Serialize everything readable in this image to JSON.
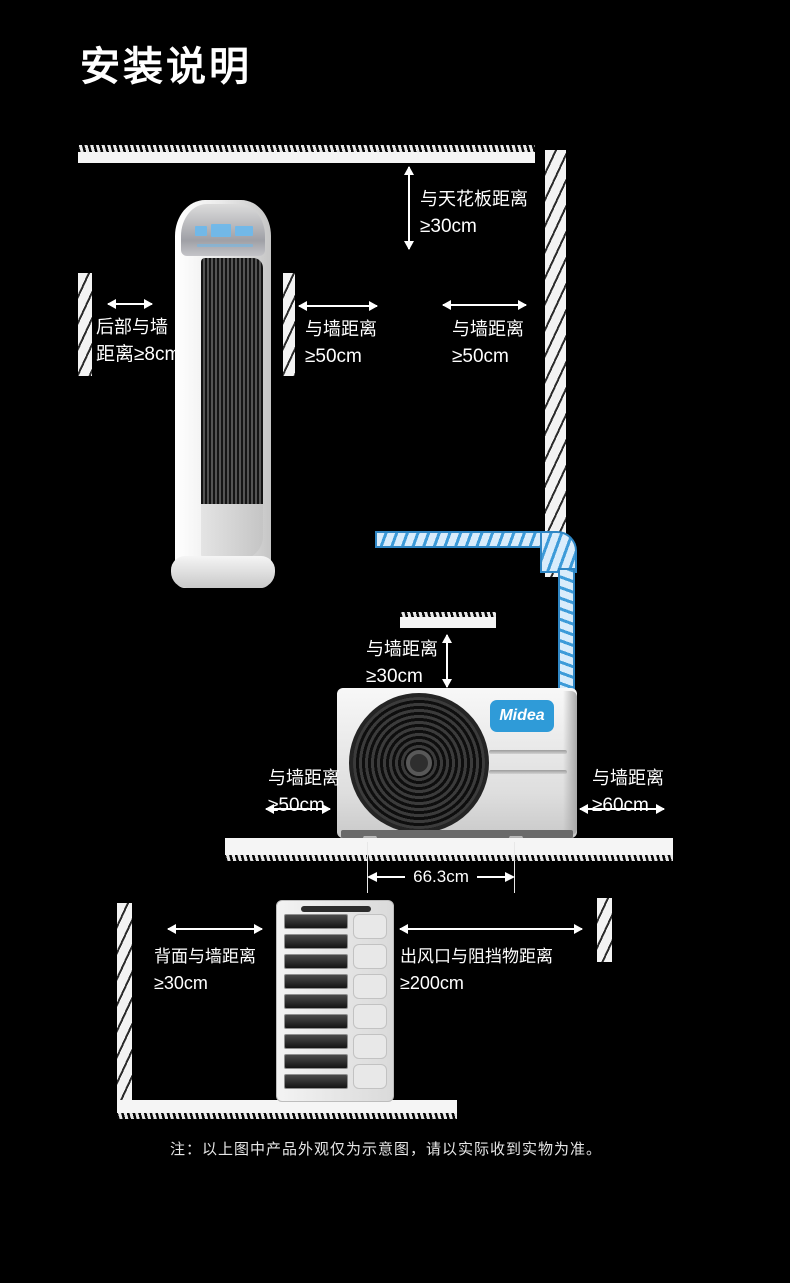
{
  "page": {
    "title": "安装说明",
    "note": "注：以上图中产品外观仅为示意图，请以实际收到实物为准。"
  },
  "colors": {
    "background": "#000000",
    "text": "#ffffff",
    "pipe_blue": "#3d9bd9",
    "logo_blue": "#2f9bd8"
  },
  "indoor_diagram": {
    "ceiling_clearance": {
      "label": "与天花板距离",
      "value": "≥30cm"
    },
    "rear_wall_clearance": {
      "label": "后部与墙",
      "value": "距离≥8cm"
    },
    "front_wall_clearance": {
      "label": "与墙距离",
      "value": "≥50cm"
    },
    "right_wall_clearance": {
      "label": "与墙距离",
      "value": "≥50cm"
    }
  },
  "outdoor_front_diagram": {
    "brand": "Midea",
    "top_wall_clearance": {
      "label": "与墙距离",
      "value": "≥30cm"
    },
    "left_wall_clearance": {
      "label": "与墙距离",
      "value": "≥50cm"
    },
    "right_wall_clearance": {
      "label": "与墙距离",
      "value": "≥60cm"
    },
    "unit_width": "66.3cm"
  },
  "outdoor_back_diagram": {
    "back_wall_clearance": {
      "label": "背面与墙距离",
      "value": "≥30cm"
    },
    "outlet_clearance": {
      "label": "出风口与阻挡物距离",
      "value": "≥200cm"
    }
  }
}
